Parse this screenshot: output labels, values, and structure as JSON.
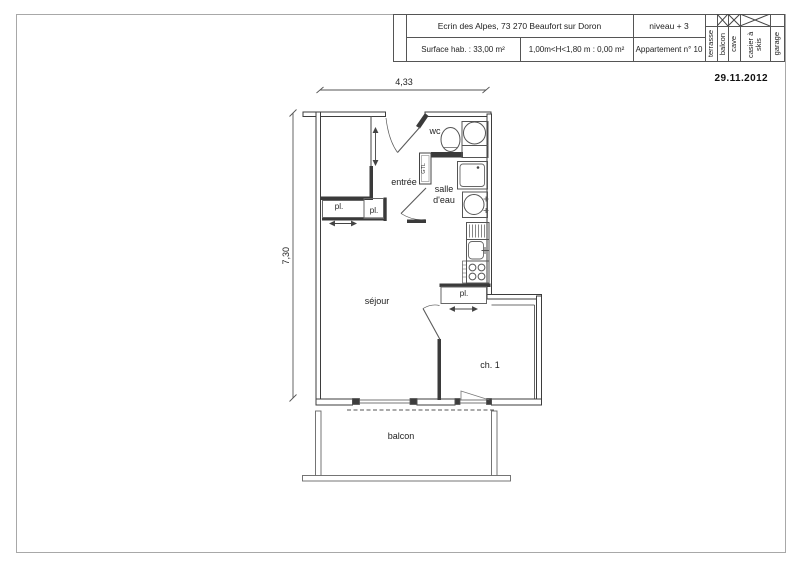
{
  "title_block": {
    "address": "Ecrin des Alpes, 73 270 Beaufort sur Doron",
    "level": "niveau + 3",
    "surface": "Surface hab. :  33,00 m²",
    "height_note": "1,00m<H<1,80 m : 0,00 m²",
    "apartment": "Appartement n° 10",
    "annexes": [
      {
        "label": "terrasse",
        "checked": false
      },
      {
        "label": "balcon",
        "checked": true
      },
      {
        "label": "cave",
        "checked": true
      },
      {
        "label": "casier à skis",
        "checked": true
      },
      {
        "label": "garage",
        "checked": false
      }
    ]
  },
  "date": "29.11.2012",
  "dimensions": {
    "width": "4,33",
    "height": "7,30"
  },
  "rooms": {
    "wc": "wc",
    "entree": "entrée",
    "salle_eau": "salle\nd'eau",
    "sejour": "séjour",
    "ch1": "ch. 1",
    "balcon": "balcon",
    "pl": "pl.",
    "gtl": "GTL"
  }
}
